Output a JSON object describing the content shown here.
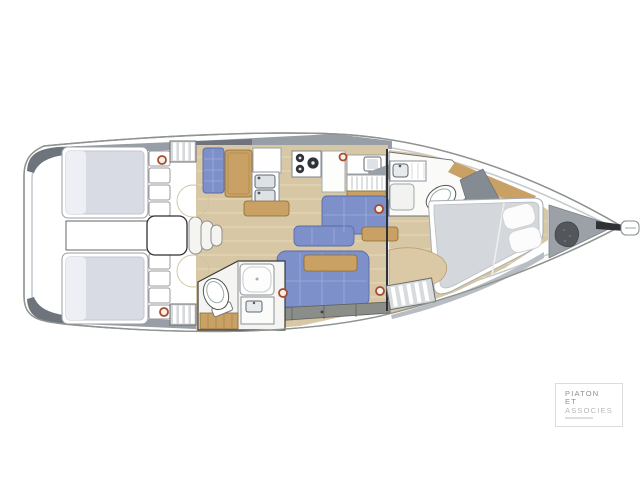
{
  "logo": {
    "line1": "PIATON",
    "line2": "ET",
    "line3": "ASSOCIES"
  },
  "palette": {
    "floor": "#d8c7a4",
    "floor_line": "#e6d9bb",
    "wood": "#c9a164",
    "wood_dark": "#8a6a34",
    "settee_blue": "#7d90c9",
    "settee_blue_dark": "#5a6cab",
    "settee_grid": "#a0aed9",
    "bed_gray": "#d9dbe4",
    "bed_fwd": "#d4d7db",
    "band_gray": "#8b8d89",
    "hull_stroke": "#8e948f",
    "deck_gray": "#c6cbd0",
    "mid_gray": "#989ea5",
    "dark_gray": "#6e747b",
    "porthole_ring": "#a84b2c",
    "logo_gray": "#8f8f8f",
    "logo_light": "#b8b8b8"
  }
}
